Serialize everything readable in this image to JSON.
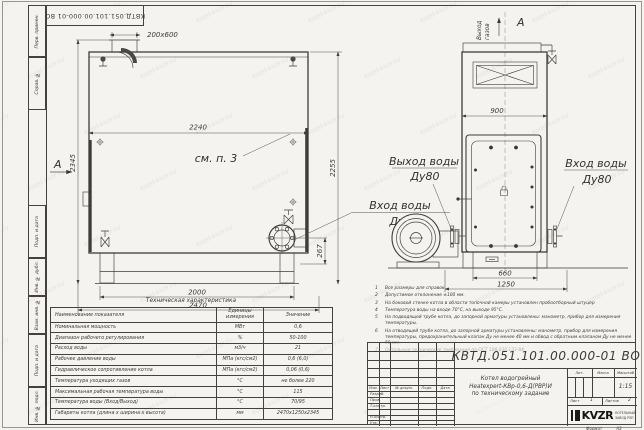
{
  "colors": {
    "bg": "#f4f3f0",
    "ink": "#3f3d39",
    "frame": "#45423d"
  },
  "watermark_text": "kotel-kvzr.ru",
  "frame": {
    "top_stamp": "КВТД.051.101.00.000-01 ВО",
    "side_labels": [
      "Перв. примен.",
      "Справ. №",
      "Подп. и дата",
      "Инв. № дубл.",
      "Взам. инв. №",
      "Подп. и дата",
      "Инв. № подл."
    ],
    "format_label": "Формат",
    "format_value": "А3"
  },
  "front_view": {
    "section_arrow": "А",
    "see_note": "см. п. 3",
    "dim_chimney": "200х600",
    "dim_width_top": "2240",
    "dim_height_left": "2345",
    "dim_height_right": "2255",
    "dim_flange": "267",
    "dim_base_inner": "2000",
    "dim_base_outer": "2470",
    "label_inlet_1": "Вход воды",
    "label_inlet_2": "Ду80"
  },
  "side_view": {
    "view_label": "А",
    "gas_out_1": "Выход",
    "gas_out_2": "газов",
    "dim_width": "900",
    "dim_base_inner": "660",
    "dim_base_outer": "1250",
    "label_outlet_1": "Выход воды",
    "label_outlet_2": "Ду80",
    "label_inlet_1": "Вход воды",
    "label_inlet_2": "Ду80"
  },
  "notes": [
    {
      "n": "1",
      "t": "Все размеры для справок"
    },
    {
      "n": "2",
      "t": "Допустимое отклонение ±100 мм."
    },
    {
      "n": "3",
      "t": "На боковой стенке котла в области топочной камеры установлен пробоотборный штуцер"
    },
    {
      "n": "4",
      "t": "Температура воды на входе 70°С, на выходе 95°С."
    },
    {
      "n": "5",
      "t": "На подводящей трубе котла, до запорной арматуры установлены: манометр, прибор для измерения температуры."
    },
    {
      "n": "6",
      "t": "На отводящей трубе котла, до запорной арматуры установлены: манометр, прибор для измерения температуры, предохранительный клапан Ду не менее 40 мм и обвод с обратным клапаном Ду не менее 50 мм."
    },
    {
      "n": "7",
      "t": "Остальные технические требования по ОСТ 108.030.133-84."
    }
  ],
  "spec_table": {
    "title": "Техническая характеристика",
    "headers": [
      "Наименование показателя",
      "Единицы измерения",
      "Значение"
    ],
    "rows": [
      [
        "Номинальная мощность",
        "МВт",
        "0,6"
      ],
      [
        "Диапазон рабочего регулирования",
        "%",
        "50-100"
      ],
      [
        "Расход воды",
        "м3/ч",
        "21"
      ],
      [
        "Рабочее давление воды",
        "МПа (кгс/см2)",
        "0,6 (6,0)"
      ],
      [
        "Гидравлическое сопротивление котла",
        "МПа (кгс/см2)",
        "0,06 (0,6)"
      ],
      [
        "Температура уходящих газов",
        "°С",
        "не более 220"
      ],
      [
        "Максимальная рабочая температура воды",
        "°С",
        "115"
      ],
      [
        "Температура воды (Вход/Выход)",
        "°С",
        "70/95"
      ],
      [
        "Габариты котла (длина х ширина х высота)",
        "мм",
        "2470х1250х2345"
      ]
    ]
  },
  "title_block": {
    "doc_number": "КВТД.051.101.00.000-01 ВО",
    "name_line_1": "Котел водогрейный",
    "name_line_2": "Heatexpert-КВр-0,6-Д(РВР)И",
    "name_line_3": "по техническому задание",
    "col_izm": "Изм.",
    "col_list": "Лист",
    "col_doc": "№ докум.",
    "col_podp": "Подп.",
    "col_data": "Дата",
    "row_razrab": "Разраб.",
    "row_prov": "Пров.",
    "row_tkontr": "Т.контр.",
    "row_nkontr": "Н.контр.",
    "row_utv": "Утв.",
    "lit_label": "Лит.",
    "mass_label": "Масса",
    "scale_label": "Масштаб",
    "scale_value": "1:15",
    "sheet_label": "Лист",
    "sheet_value": "1",
    "sheets_label": "Листов",
    "sheets_value": "2",
    "logo_text": "KVZR",
    "logo_caption_1": "КОТЕЛЬНЫЙ",
    "logo_caption_2": "ЗАВОД РЭП"
  }
}
